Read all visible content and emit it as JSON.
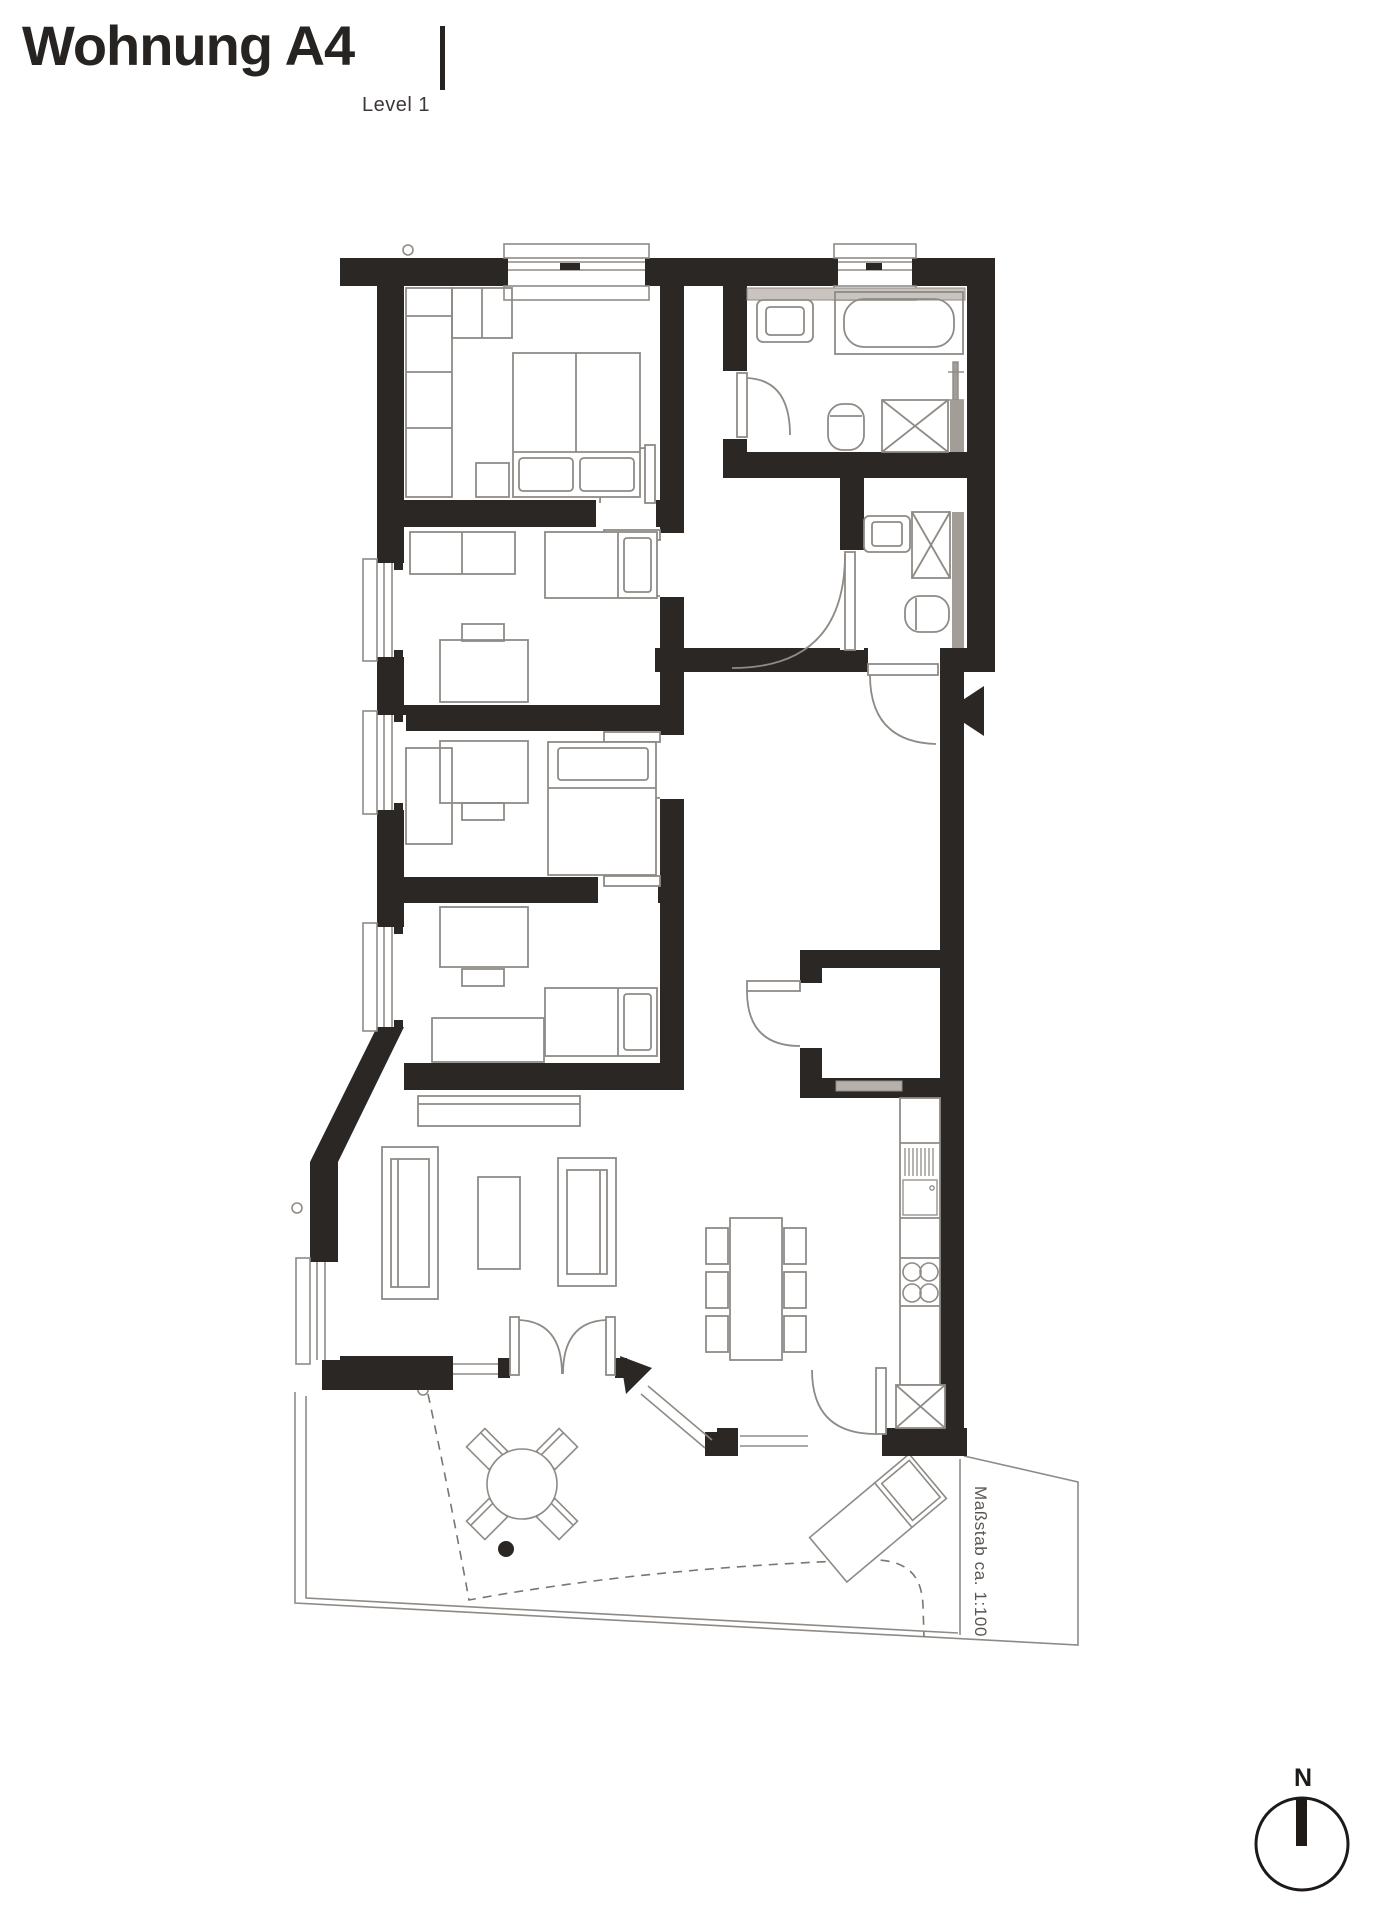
{
  "header": {
    "title": "Wohnung A4",
    "subtitle": "Level 1"
  },
  "plan": {
    "scale_note": "Maßstab ca. 1:100",
    "compass_label": "N"
  },
  "colors": {
    "wall": "#2b2725",
    "furniture_line": "#8f8a85",
    "light_gray": "#c9c4bf",
    "mid_gray": "#a39d98",
    "dashed_line": "#7a756f",
    "background": "#ffffff",
    "text": "#272320"
  },
  "icons": {
    "north-compass-icon": "circle-with-filled-bar",
    "entrance-arrow-icon": "black-triangle-pointing-left",
    "terrace-arrow-icon": "black-triangle-diagonal",
    "door-swing-icon": "quarter-arc-with-leaf",
    "shower-icon": "square-with-x",
    "stove-icon": "four-burner-circles"
  }
}
